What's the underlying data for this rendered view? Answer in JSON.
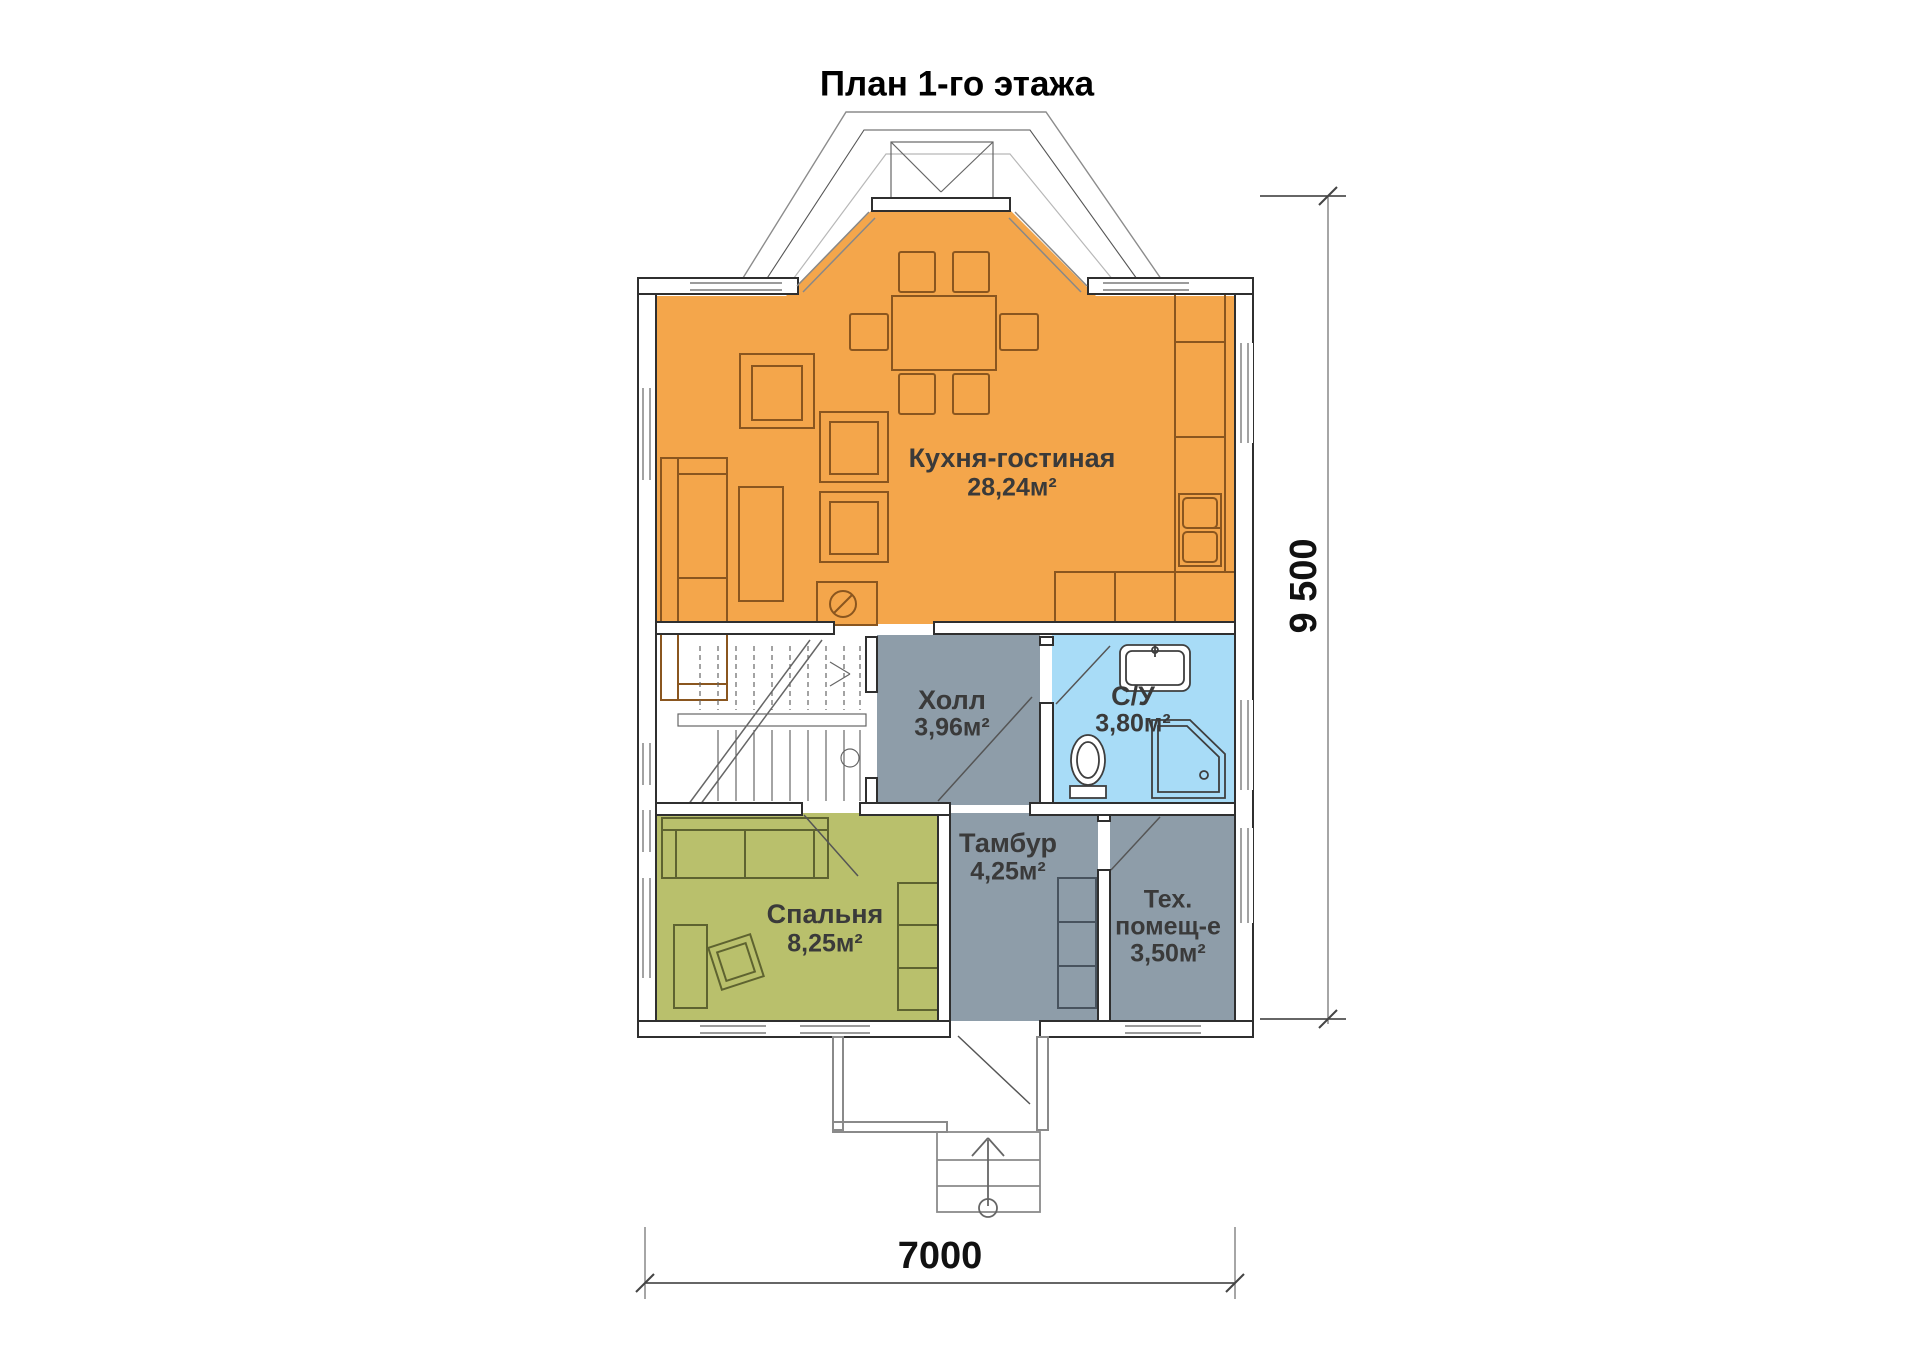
{
  "title": "План 1-го этажа",
  "rooms": [
    {
      "id": "kitchen-living",
      "name": "Кухня-гостиная",
      "area": "28,24м²",
      "color": "#F4A64B"
    },
    {
      "id": "hall",
      "name": "Холл",
      "area": "3,96м²",
      "color": "#8E9DA9"
    },
    {
      "id": "bathroom",
      "name": "С/У",
      "area": "3,80м²",
      "color": "#A8DCF7"
    },
    {
      "id": "bedroom",
      "name": "Спальня",
      "area": "8,25м²",
      "color": "#B9C06C"
    },
    {
      "id": "vestibule",
      "name": "Тамбур",
      "area": "4,25м²",
      "color": "#8E9DA9"
    },
    {
      "id": "tech-room",
      "name_line1": "Тех.",
      "name_line2": "помещ-е",
      "area": "3,50м²",
      "color": "#8E9DA9"
    }
  ],
  "dimensions": {
    "height_label": "9 500",
    "width_label": "7000"
  }
}
